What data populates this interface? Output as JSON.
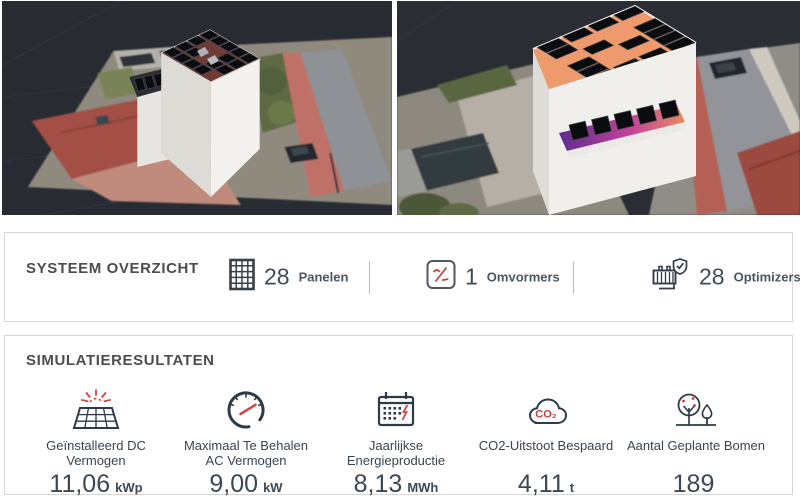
{
  "system_overview": {
    "title": "SYSTEEM OVERZICHT",
    "stats": [
      {
        "value": "28",
        "label": "Panelen",
        "icon": "solar-panels-grid-icon"
      },
      {
        "value": "1",
        "label": "Omvormers",
        "icon": "inverter-icon"
      },
      {
        "value": "28",
        "label": "Optimizers",
        "icon": "optimizer-icon"
      }
    ]
  },
  "simulation_results": {
    "title": "SIMULATIERESULTATEN",
    "metrics": [
      {
        "label": "Geïnstalleerd DC Vermogen",
        "value": "11,06",
        "unit": "kWp",
        "icon": "solar-panel-sun-icon"
      },
      {
        "label": "Maximaal Te Behalen AC Vermogen",
        "value": "9,00",
        "unit": "kW",
        "icon": "gauge-icon"
      },
      {
        "label": "Jaarlijkse Energieproductie",
        "value": "8,13",
        "unit": "MWh",
        "icon": "calendar-energy-icon"
      },
      {
        "label": "CO2-Uitstoot Bespaard",
        "value": "4,11",
        "unit": "t",
        "icon": "co2-cloud-icon",
        "icon_text": "CO₂"
      },
      {
        "label": "Aantal Geplante Bomen",
        "value": "189",
        "unit": "",
        "icon": "trees-icon"
      }
    ]
  },
  "colors": {
    "accent_red": "#c8403c",
    "icon_navy": "#2f3a46",
    "viewport_background": "#282c32",
    "roof_highlight_orange": "#ef9a6d",
    "ledge_gradient": [
      "#5c2d8f",
      "#c2409a",
      "#e78a5e"
    ],
    "card_border": "#d7d7d7"
  }
}
